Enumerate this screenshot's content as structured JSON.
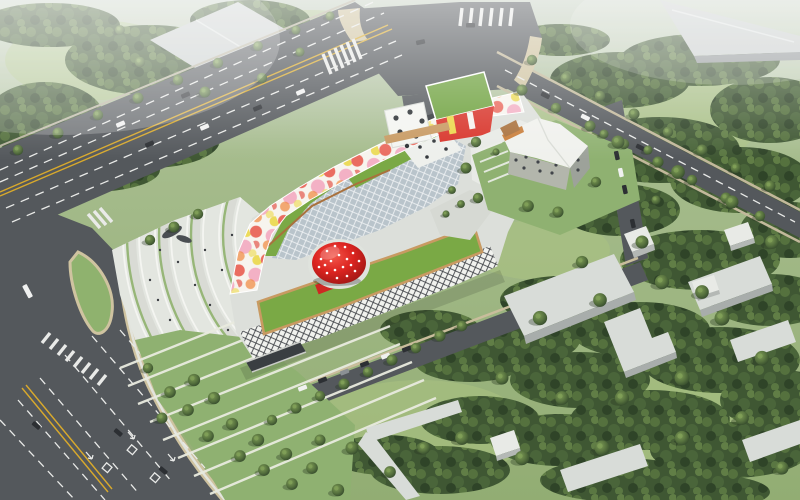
{
  "scene": {
    "type": "aerial-architectural-rendering",
    "subject": "mixed-use cultural complex with painted ribbon facade, sloped green roofs, glass diagrid atrium and a red strawberry-shaped dome, fronted by a fan-shaped stepped plaza, ringed by boulevards, lawns and forest park"
  },
  "colors": {
    "grass": "#96b177",
    "grass_light": "#abc382",
    "forest_dark": "#3f5733",
    "road": "#54585c",
    "lane_white": "#e9eae8",
    "lane_yellow": "#d8a92c",
    "sidewalk_tan": "#cfc3a0",
    "plaza": "#e3e6e0",
    "plaza_step": "#f4f5f1",
    "plaza_green": "#8fb26e",
    "building_white": "#f2f3ef",
    "building_base": "#dcdfda",
    "diagrid_glass": "#b9c4cb",
    "ribbon_white": "#f7f4ee",
    "ribbon_red": "#e03a2f",
    "ribbon_pink": "#f2a0ba",
    "ribbon_yellow": "#ecd94b",
    "ribbon_orange": "#f08030",
    "green_roof": "#7aa945",
    "roof_path": "#c89a62",
    "strawberry": "#d81f1c",
    "strawberry_dot": "#ffffff",
    "office_wall": "#b3b6ac",
    "office_roof": "#f0f1ed",
    "office_accent": "#c97e3a",
    "warehouse": "#c9cecd",
    "slab_roof": "#d8dcd8",
    "car_dark": "#2c2f33",
    "car_white": "#f0f1f0",
    "people": "#3c3f43",
    "shadow": "#000000"
  }
}
